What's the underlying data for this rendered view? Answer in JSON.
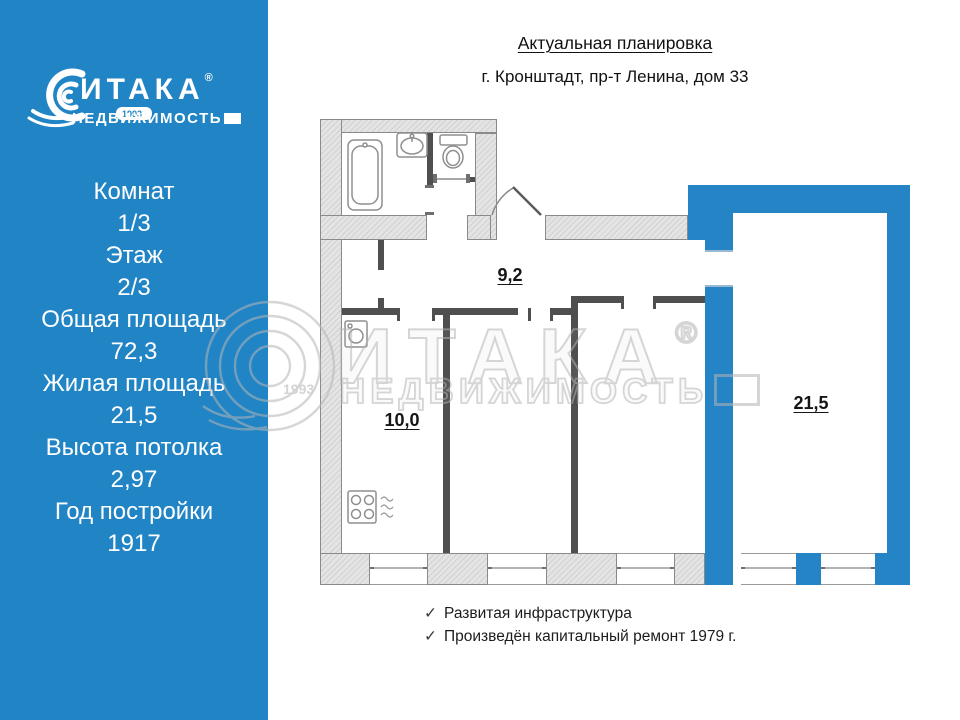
{
  "sidebar": {
    "logo": {
      "brand": "ИТАКА",
      "registered": "®",
      "sub_brand": "НЕДВИЖИМОСТЬ",
      "year": "1993"
    },
    "stats": [
      {
        "label": "Комнат",
        "value": "1/3"
      },
      {
        "label": "Этаж",
        "value": "2/3"
      },
      {
        "label": "Общая площадь",
        "value": "72,3"
      },
      {
        "label": "Жилая площадь",
        "value": "21,5"
      },
      {
        "label": "Высота потолка",
        "value": "2,97"
      },
      {
        "label": "Год постройки",
        "value": "1917"
      }
    ]
  },
  "header": {
    "title": "Актуальная планировка",
    "subtitle": "г. Кронштадт, пр-т Ленина, дом 33"
  },
  "floorplan": {
    "rooms": [
      {
        "name": "hallway",
        "area_label": "9,2"
      },
      {
        "name": "kitchen",
        "area_label": "10,0"
      },
      {
        "name": "living-room",
        "area_label": "21,5",
        "highlighted": true
      }
    ],
    "accent_color": "#2484c6",
    "wall_color": "#e4e4e4"
  },
  "watermark": {
    "brand": "ИТАКА",
    "registered": "®",
    "sub_brand": "НЕДВИЖИМОСТЬ",
    "year": "1993"
  },
  "footer": {
    "check": "✓",
    "items": [
      "Развитая инфраструктура",
      "Произведён капитальный ремонт 1979 г."
    ]
  }
}
